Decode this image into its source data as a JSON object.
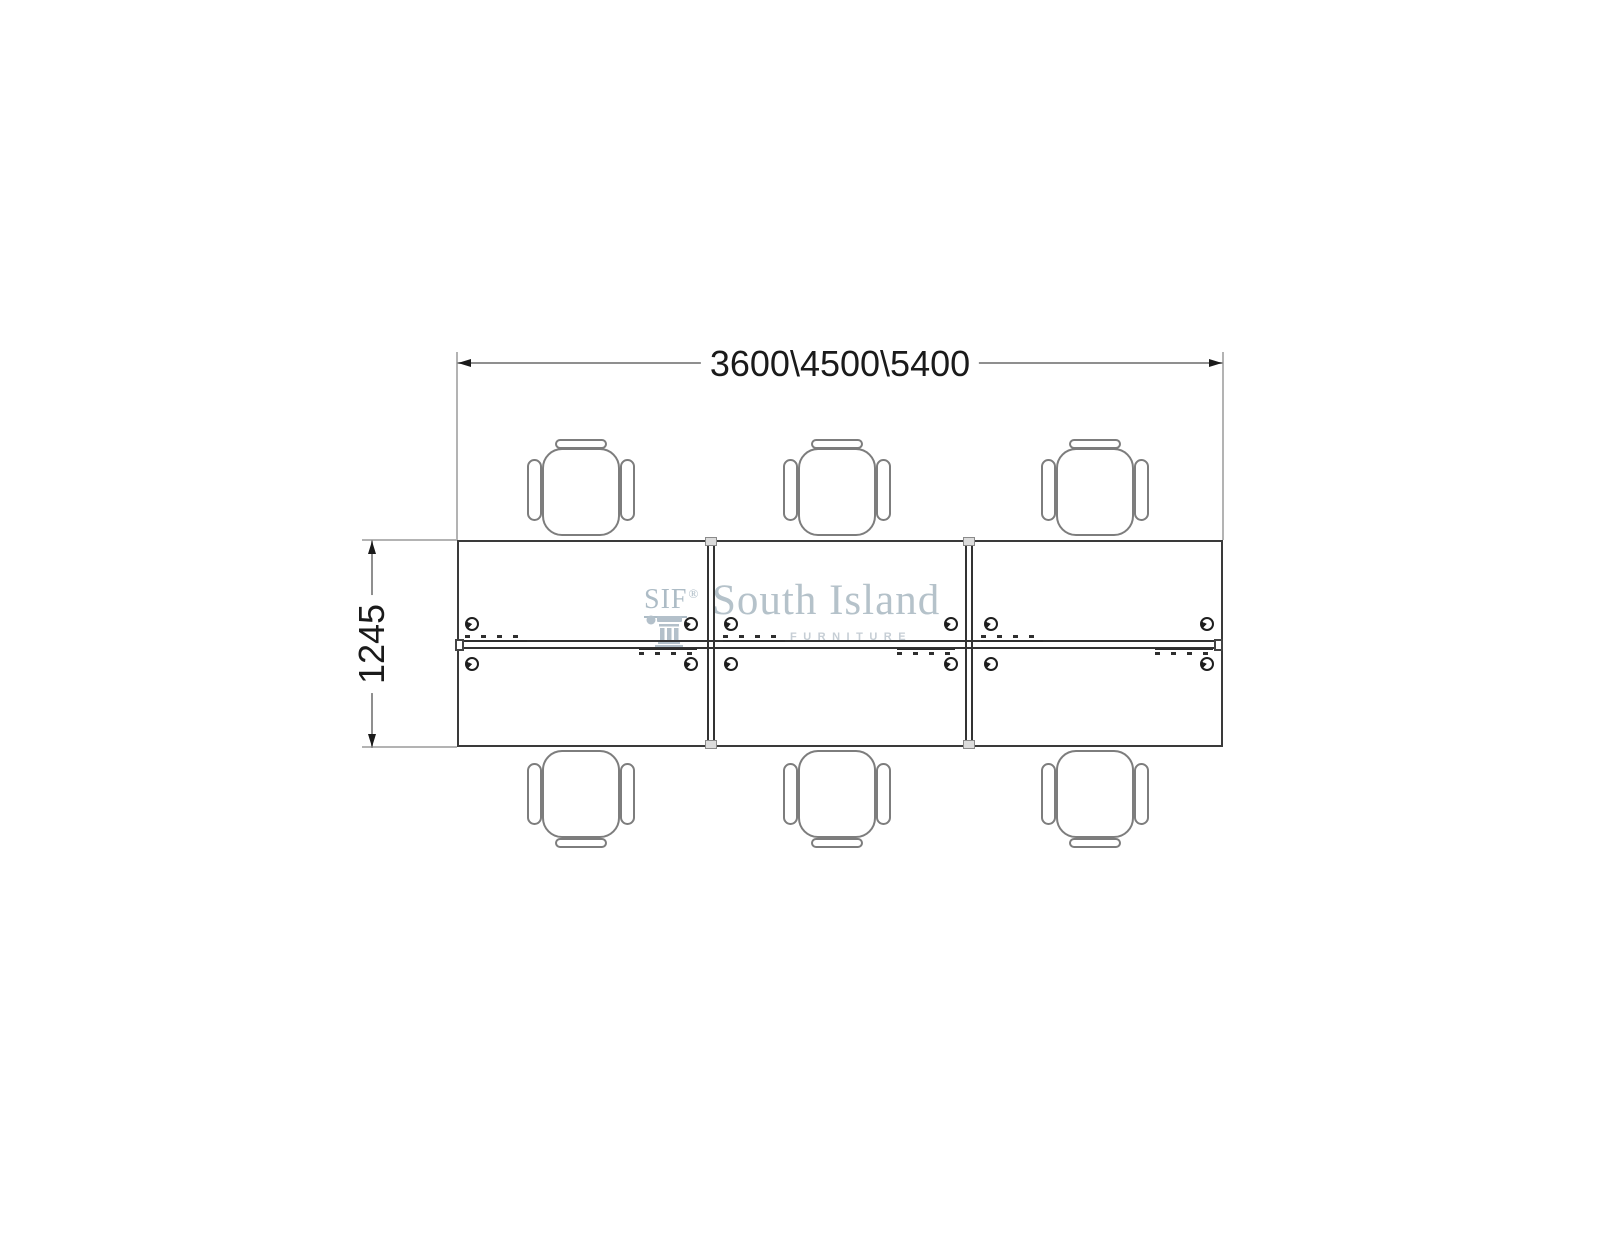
{
  "dimensions": {
    "width_label": "3600\\4500\\5400",
    "depth_label": "1245"
  },
  "watermark": {
    "abbr": "SIF",
    "registered": "®",
    "name": "South Island",
    "subtitle": "FURNITURE"
  },
  "layout_summary": {
    "bays": 3,
    "workstations": 6,
    "chairs": 6,
    "grommets": 12
  },
  "colors": {
    "desk_outline": "#3a3a3a",
    "chair_outline": "#7d7d7d",
    "dimension_line": "#8f8f8f",
    "extension_line": "#b3b3b3",
    "dimension_text": "#1a1a1a",
    "watermark": "#b5c2ca",
    "background": "#ffffff"
  }
}
